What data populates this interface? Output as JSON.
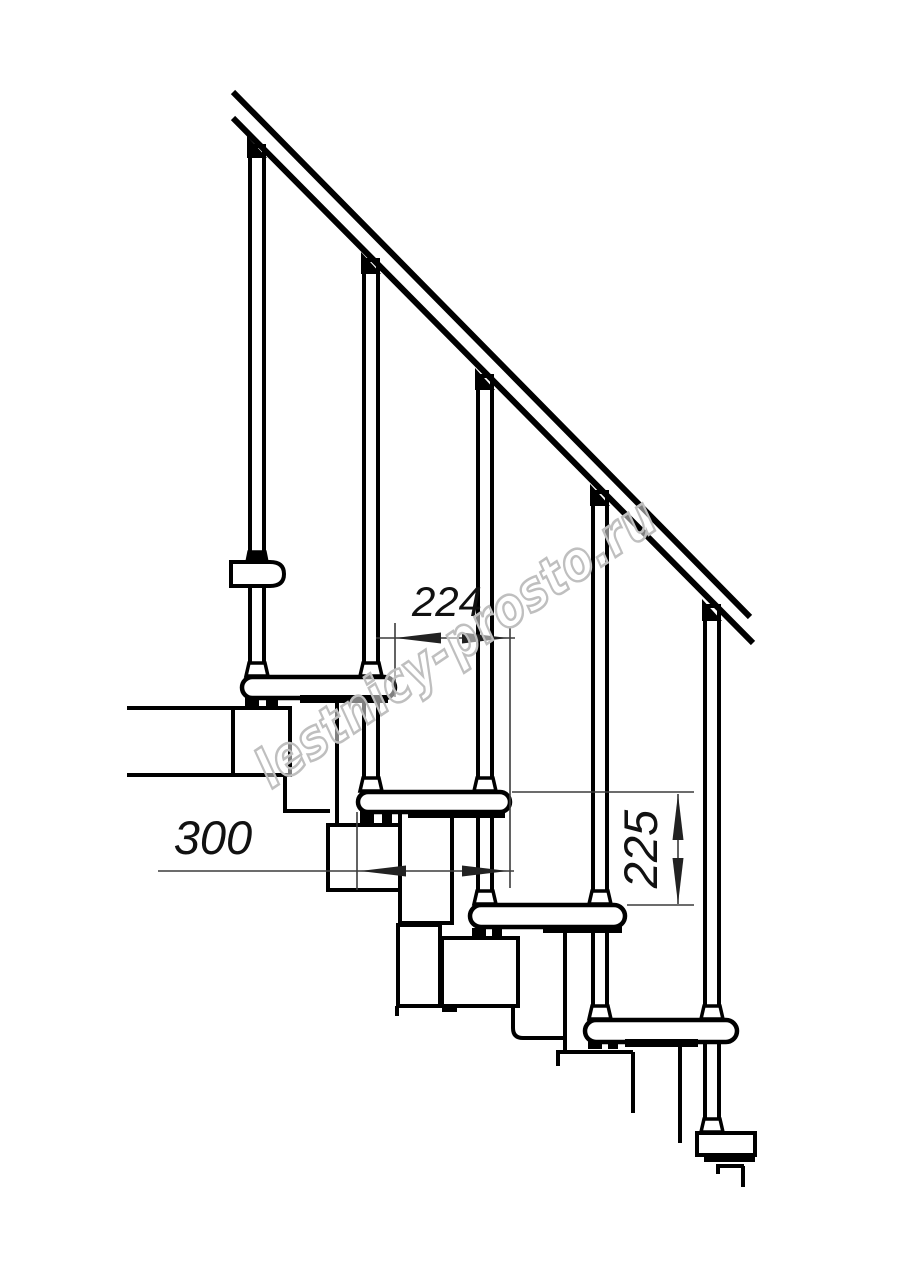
{
  "drawing": {
    "type": "staircase-side-view-technical-drawing",
    "dimensions": {
      "tread_offset_label": "224",
      "tread_depth_label": "300",
      "riser_height_label": "225"
    },
    "watermark": {
      "text": "lestnicy-prosto.ru"
    },
    "colors": {
      "line": "#000000",
      "dimension_line": "#3c3c3c",
      "dimension_text": "#111111",
      "watermark": "#bfbfbf",
      "background": "#ffffff"
    }
  }
}
